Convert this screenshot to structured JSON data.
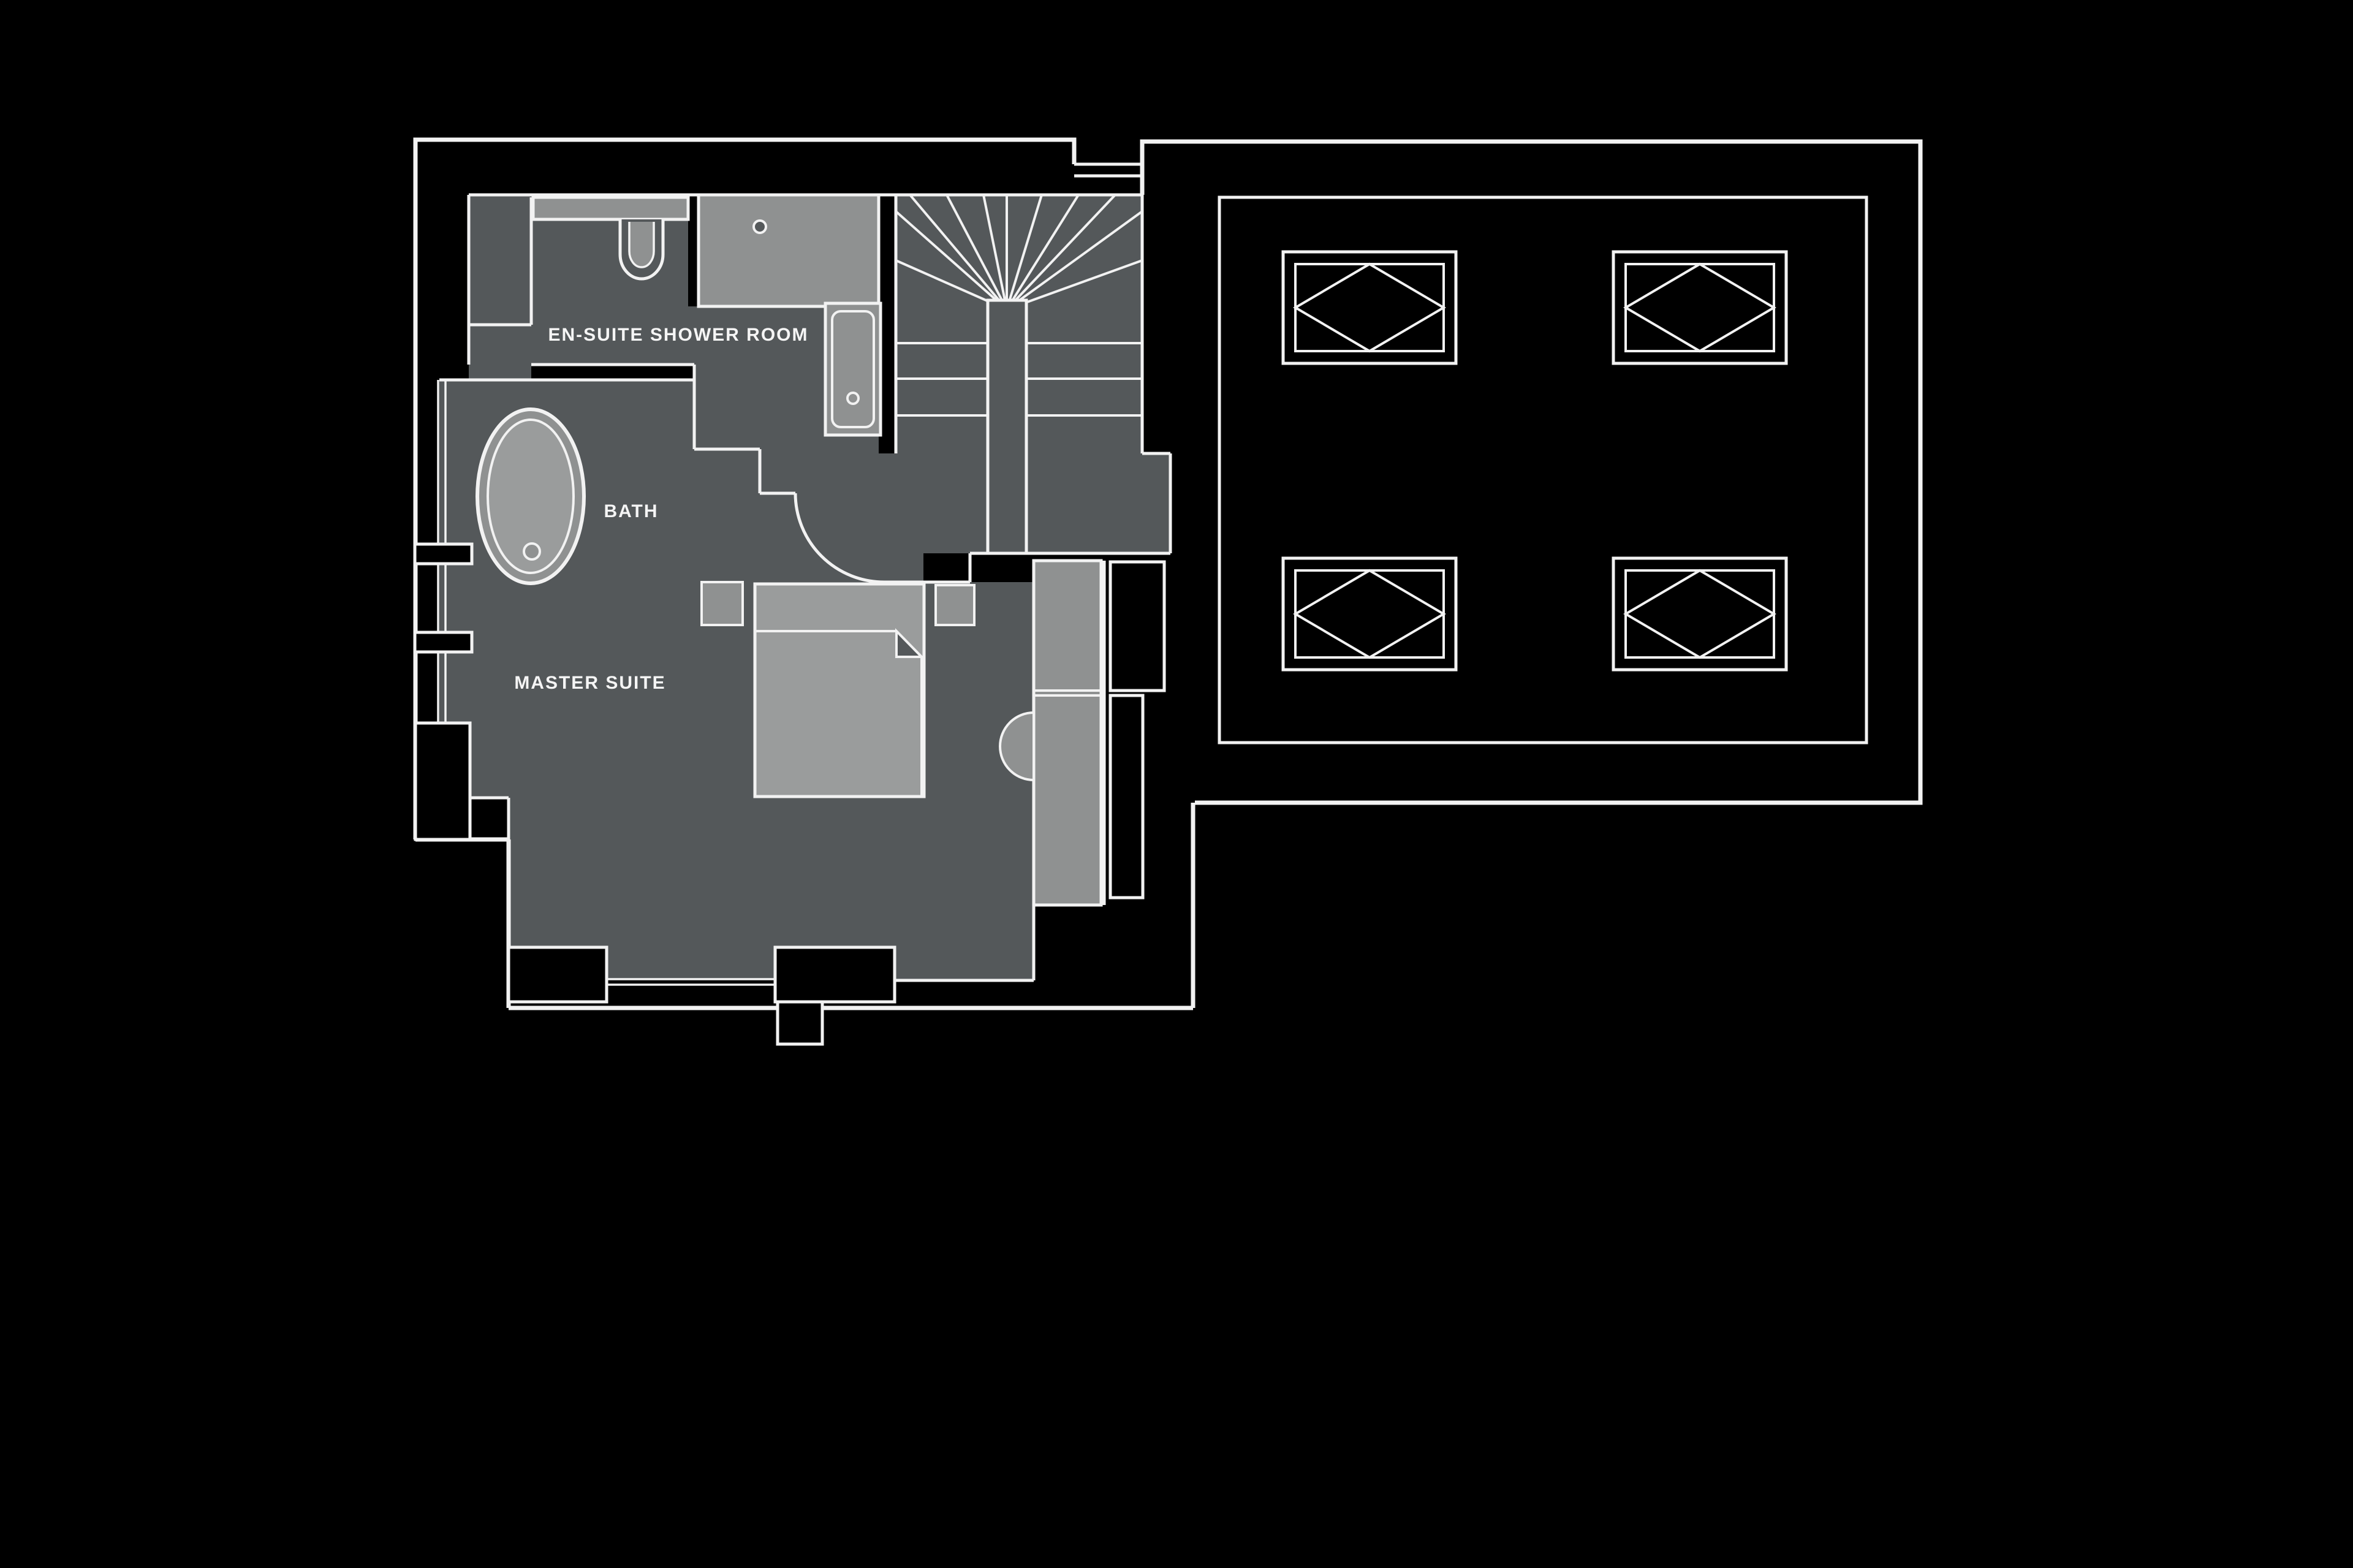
{
  "document": {
    "type": "architectural-floor-plan",
    "background": "#000000",
    "line_color": "#f2f2f2",
    "floor_color": "#54585a",
    "fixture_color": "#8f9191",
    "fixture_light_color": "#9a9c9c"
  },
  "rooms": [
    {
      "id": "en_suite",
      "label": "EN-SUITE SHOWER ROOM"
    },
    {
      "id": "bath",
      "label": "BATH"
    },
    {
      "id": "master",
      "label": "MASTER SUITE"
    }
  ],
  "fixtures": [
    {
      "name": "oval-bathtub"
    },
    {
      "name": "toilet"
    },
    {
      "name": "vanity-basin"
    },
    {
      "name": "shower-enclosure"
    },
    {
      "name": "winder-staircase"
    },
    {
      "name": "double-bed"
    },
    {
      "name": "bedside-table",
      "count": 2
    },
    {
      "name": "wardrobe"
    },
    {
      "name": "skylight",
      "count": 4
    }
  ]
}
